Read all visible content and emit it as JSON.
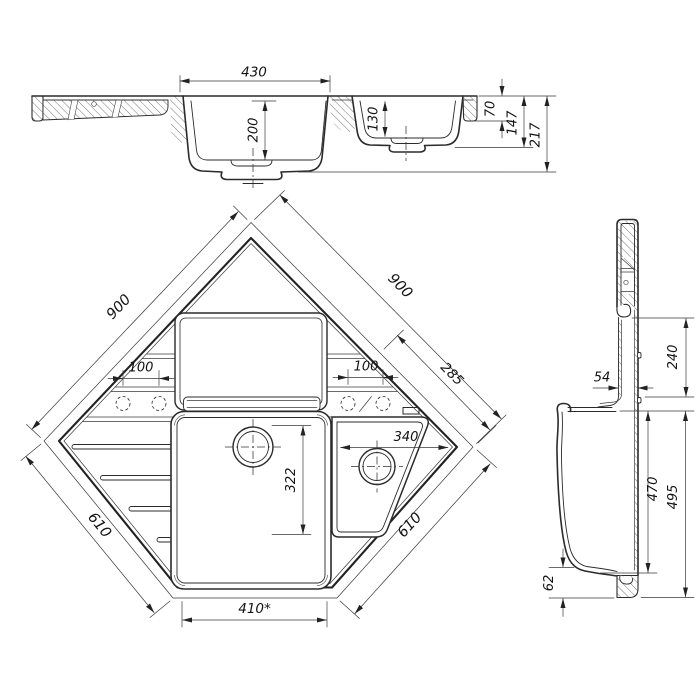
{
  "drawing": {
    "kind": "technical-drawing",
    "subject": "corner kitchen sink, three orthographic section views",
    "colors": {
      "line": "#2b2b2b",
      "dim_text": "#141414",
      "background": "#ffffff"
    }
  },
  "views": {
    "section": {
      "label": "front-section-view",
      "dims": {
        "bowl_top_width": "430",
        "main_bowl_depth": "200",
        "small_bowl_depth": "130",
        "rim_step": "70",
        "small_bowl_height": "147",
        "total_height": "217"
      }
    },
    "plan": {
      "label": "top-plan-view",
      "dims": {
        "edge_top_left": "900",
        "edge_top_right": "900",
        "tap_span_left": "100",
        "tap_span_right": "100",
        "corner_edge": "285",
        "small_bowl_width": "340",
        "main_bowl_length": "322",
        "edge_bottom_left": "610",
        "edge_bottom_right": "610",
        "front_edge": "410*"
      }
    },
    "side": {
      "label": "side-section-view",
      "dims": {
        "wall_thickness": "54",
        "back_panel_height": "240",
        "bowl_depth_inner": "470",
        "bowl_depth_outer": "495",
        "bottom_flange": "62"
      }
    }
  }
}
